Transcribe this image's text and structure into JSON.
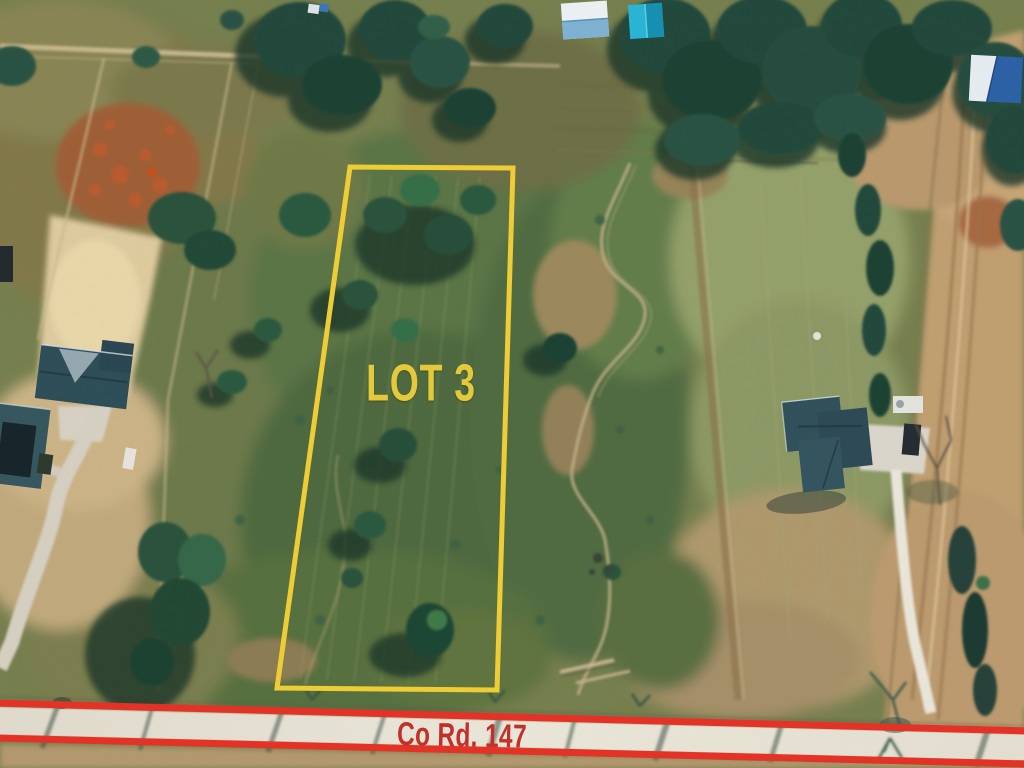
{
  "annotations": {
    "lot_label": "LOT 3",
    "road_label": "Co Rd. 147",
    "lot_outline_color": "#F2CF35",
    "road_line_color": "#E63227",
    "road_label_color": "#C2302A"
  }
}
